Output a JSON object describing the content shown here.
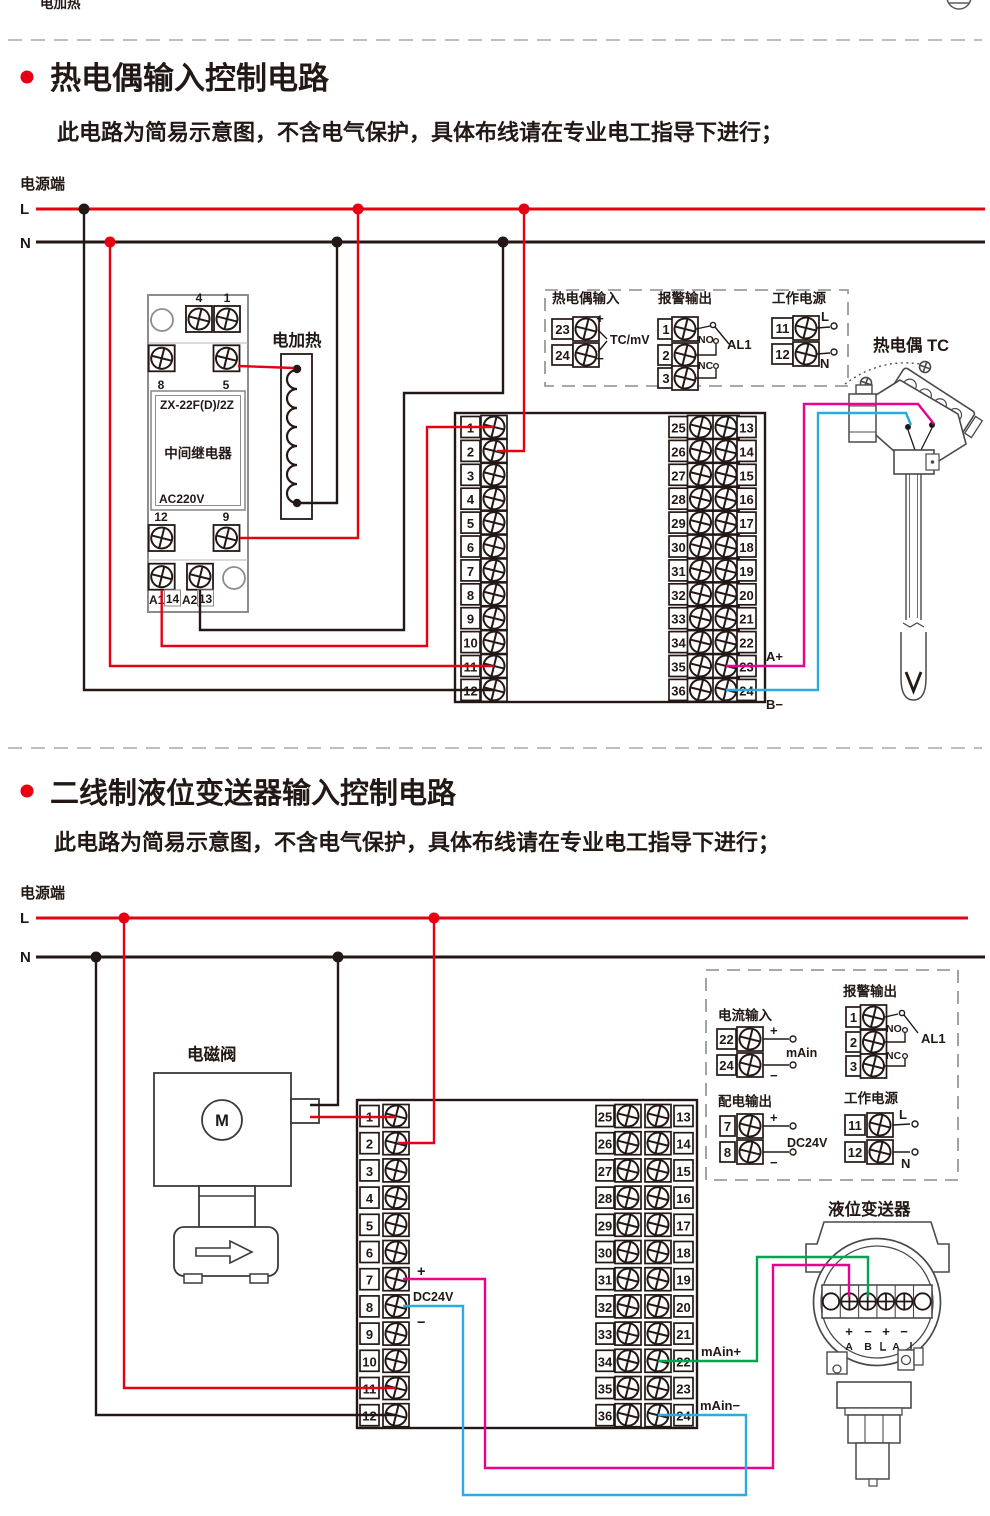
{
  "header": {
    "partial_top_label": "电加热"
  },
  "shared": {
    "subtitle": "此电路为简易示意图，不含电气保护，具体布线请在专业电工指导下进行；",
    "power_terminal": "电源端",
    "l": "L",
    "n": "N",
    "block_numbers": {
      "left": [
        "1",
        "2",
        "3",
        "4",
        "5",
        "6",
        "7",
        "8",
        "9",
        "10",
        "11",
        "12"
      ],
      "mid": [
        "25",
        "26",
        "27",
        "28",
        "29",
        "30",
        "31",
        "32",
        "33",
        "34",
        "35",
        "36"
      ],
      "right": [
        "13",
        "14",
        "15",
        "16",
        "17",
        "18",
        "19",
        "20",
        "21",
        "22",
        "23",
        "24"
      ]
    },
    "alarm": {
      "title": "报警输出",
      "t": [
        "1",
        "2",
        "3"
      ],
      "no": "NO",
      "nc": "NC",
      "name": "AL1"
    },
    "work_power": {
      "title": "工作电源",
      "t": [
        "11",
        "12"
      ],
      "l": "L",
      "n": "N"
    }
  },
  "s1": {
    "title": "热电偶输入控制电路",
    "relay": {
      "model": "ZX-22F(D)/2Z",
      "name": "中间继电器",
      "voltage": "AC220V",
      "pin4": "4",
      "pin1": "1",
      "pin8": "8",
      "pin5": "5",
      "pin12": "12",
      "pin9": "9",
      "a1": "A1",
      "p14": "14",
      "a2": "A2",
      "p13": "13"
    },
    "heater": "电加热",
    "tc_input": {
      "title": "热电偶输入",
      "t": [
        "23",
        "24"
      ],
      "plus": "+",
      "minus": "−",
      "signal": "TC/mV"
    },
    "sensor": "热电偶 TC",
    "a_plus": "A+",
    "b_minus": "B−"
  },
  "s2": {
    "title": "二线制液位变送器输入控制电路",
    "valve": "电磁阀",
    "motor": "M",
    "current_input": {
      "title": "电流输入",
      "t": [
        "22",
        "24"
      ],
      "plus": "+",
      "minus": "−",
      "signal": "mAin"
    },
    "dist_output": {
      "title": "配电输出",
      "t": [
        "7",
        "8"
      ],
      "plus": "+",
      "minus": "−",
      "signal": "DC24V"
    },
    "transmitter": "液位变送器",
    "dc_label": {
      "plus": "+",
      "name": "DC24V",
      "minus": "−"
    },
    "main_plus": "mAin+",
    "main_minus": "mAin−",
    "strip": {
      "p1": "+",
      "m1": "−",
      "p2": "+",
      "m2": "−",
      "a": "A",
      "b": "B",
      "a2": "A"
    }
  },
  "colors": {
    "live": "#e60012",
    "neutral": "#231815",
    "magenta": "#ec008c",
    "cyan": "#2aabe2",
    "green": "#00a551"
  }
}
